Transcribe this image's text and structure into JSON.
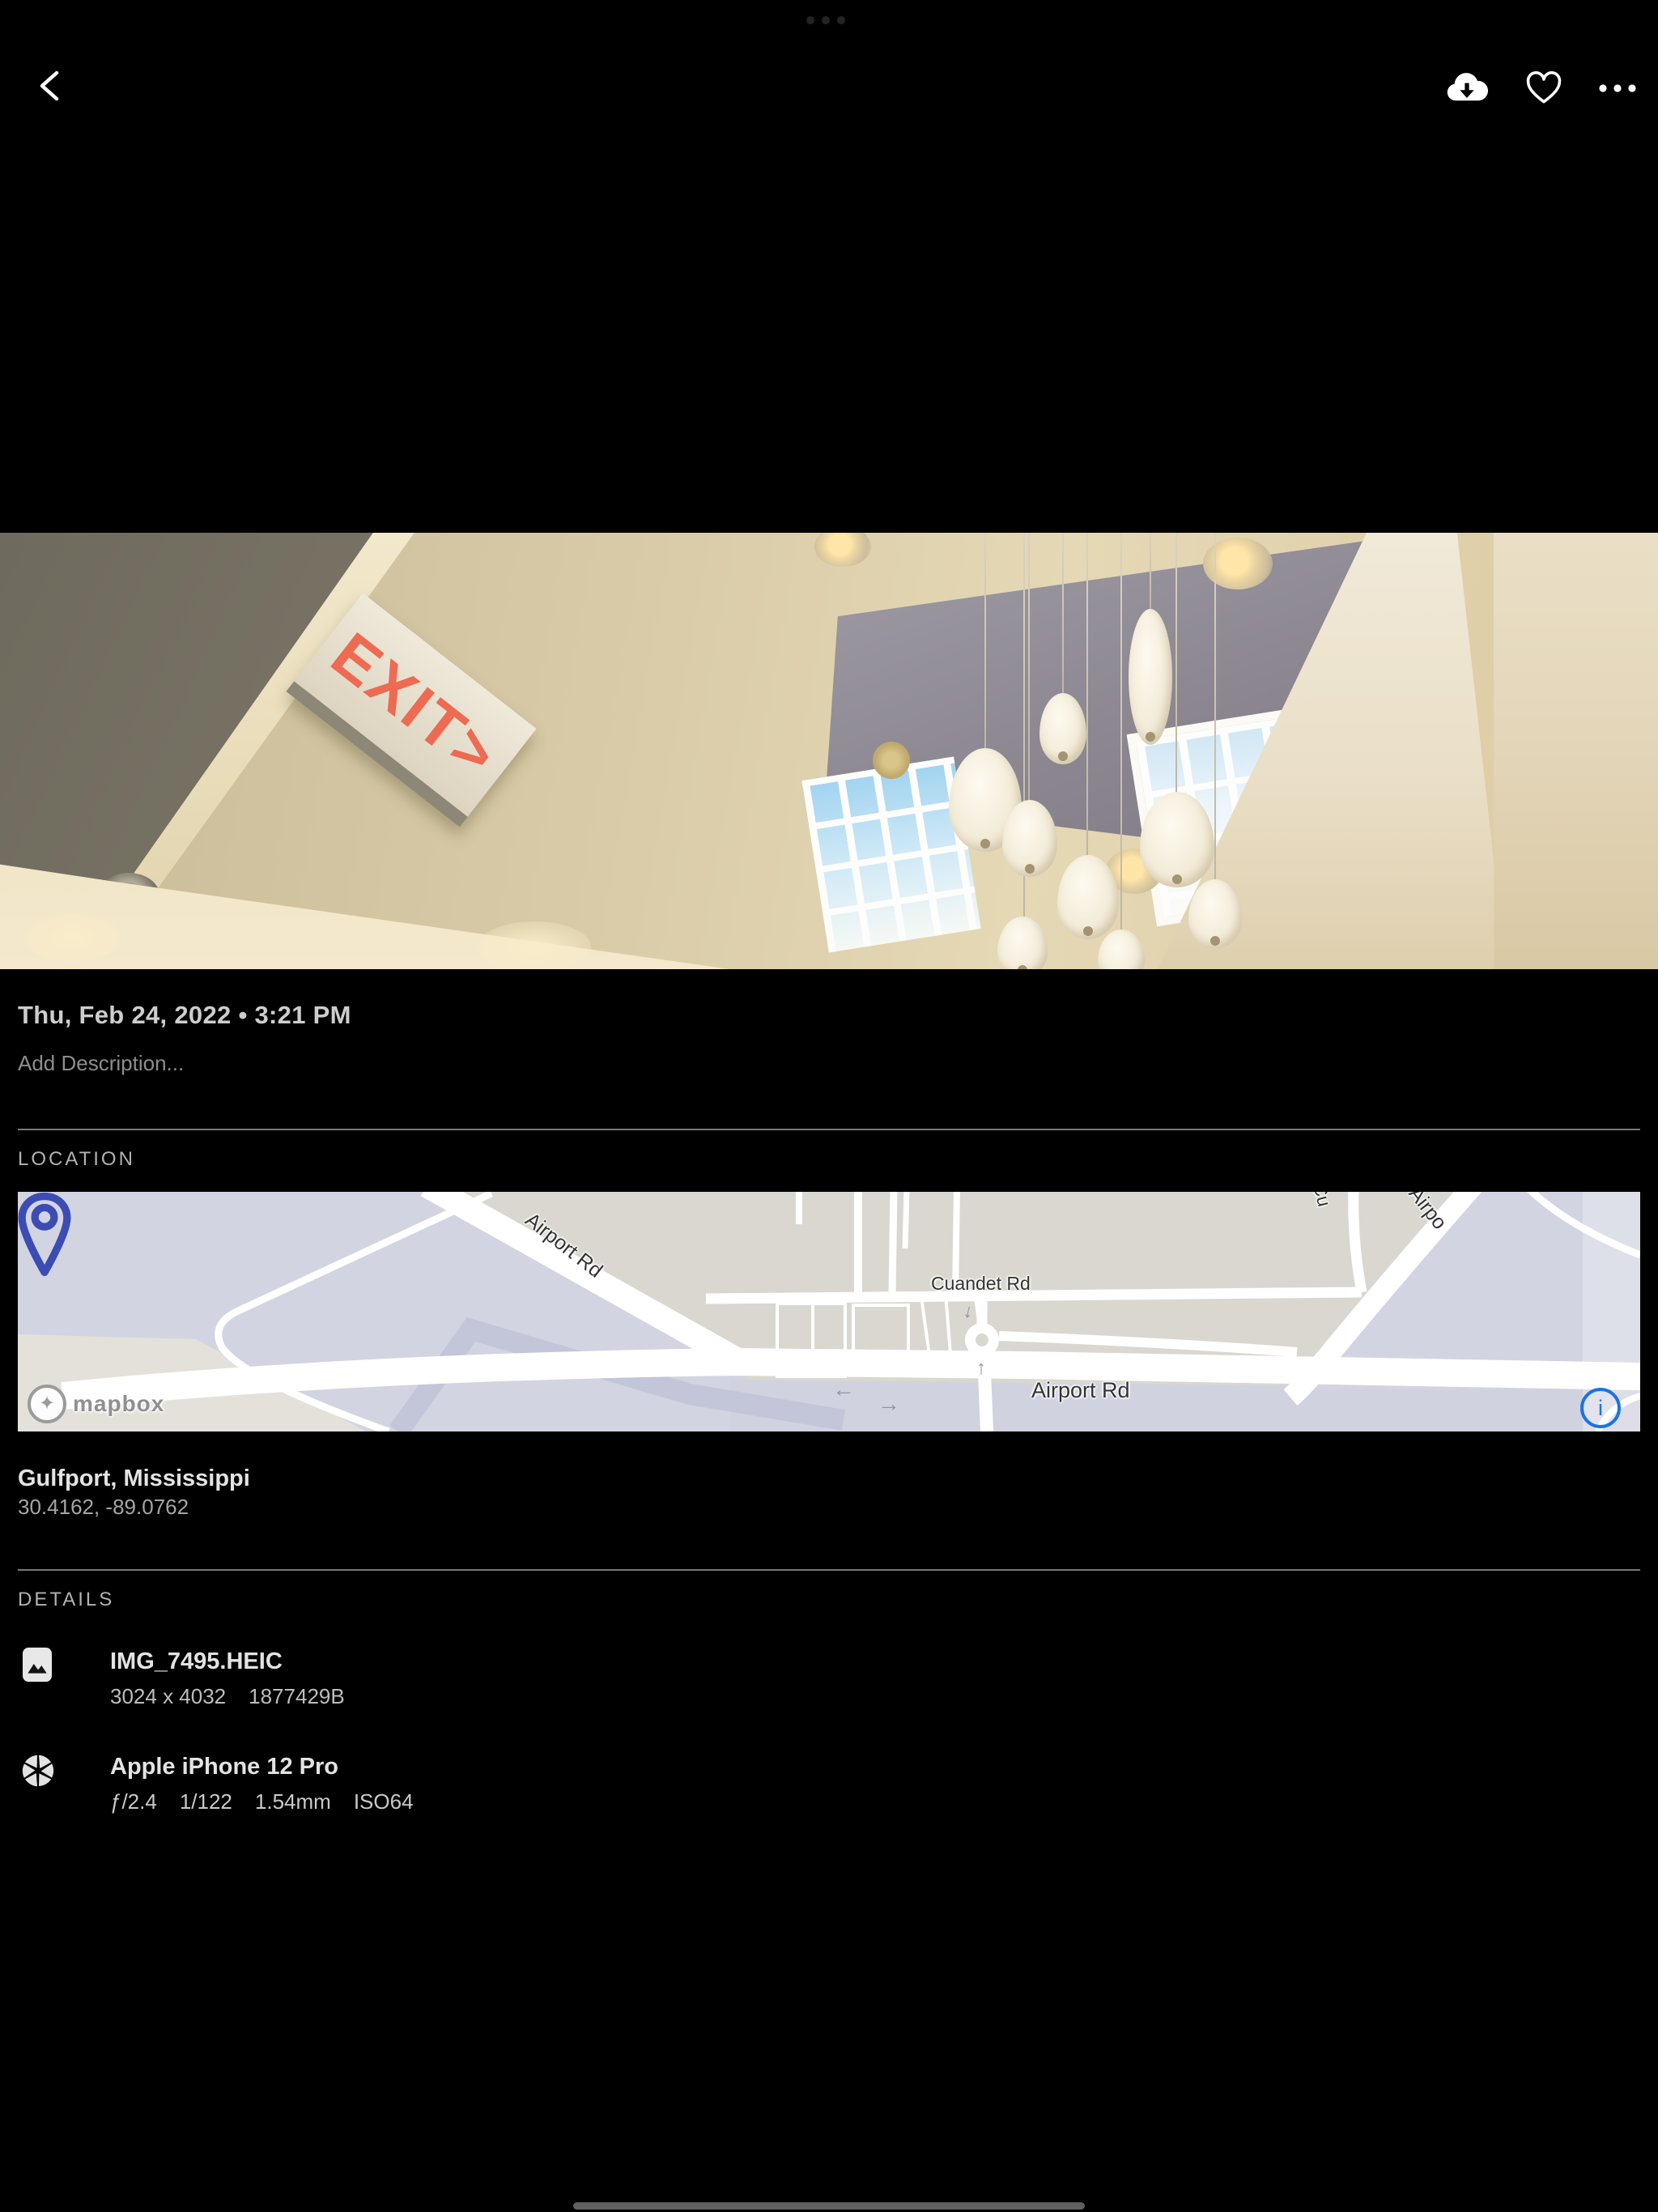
{
  "toolbar": {
    "back": "back",
    "download": "download",
    "favorite": "favorite",
    "more": "more"
  },
  "photo": {
    "exit_sign": "EXIT>"
  },
  "meta": {
    "datetime": "Thu, Feb 24, 2022 • 3:21 PM",
    "description_placeholder": "Add Description..."
  },
  "location": {
    "section_label": "LOCATION",
    "place": "Gulfport, Mississippi",
    "coordinates": "30.4162, -89.0762",
    "map": {
      "attribution": "mapbox",
      "labels": {
        "airport_rd_diagonal": "Airport Rd",
        "cuandet_rd": "Cuandet Rd",
        "airport_rd_main": "Airport Rd",
        "cu_partial": "Cu",
        "airport_partial": "Airpo"
      },
      "arrows": {
        "left": "←",
        "right": "→",
        "up": "↑",
        "down": "↓"
      },
      "info_glyph": "i"
    }
  },
  "details": {
    "section_label": "DETAILS",
    "file": {
      "name": "IMG_7495.HEIC",
      "dimensions": "3024 x 4032",
      "size": "1877429B"
    },
    "camera": {
      "name": "Apple iPhone 12 Pro",
      "aperture": "ƒ/2.4",
      "shutter_speed": "1/122",
      "focal_length": "1.54mm",
      "iso": "ISO64"
    }
  },
  "colors": {
    "accent_blue": "#1a73e8",
    "pin_indigo": "#3c4cb4",
    "map_land": "#d9d7cf",
    "map_water": "#d2d4e1"
  }
}
